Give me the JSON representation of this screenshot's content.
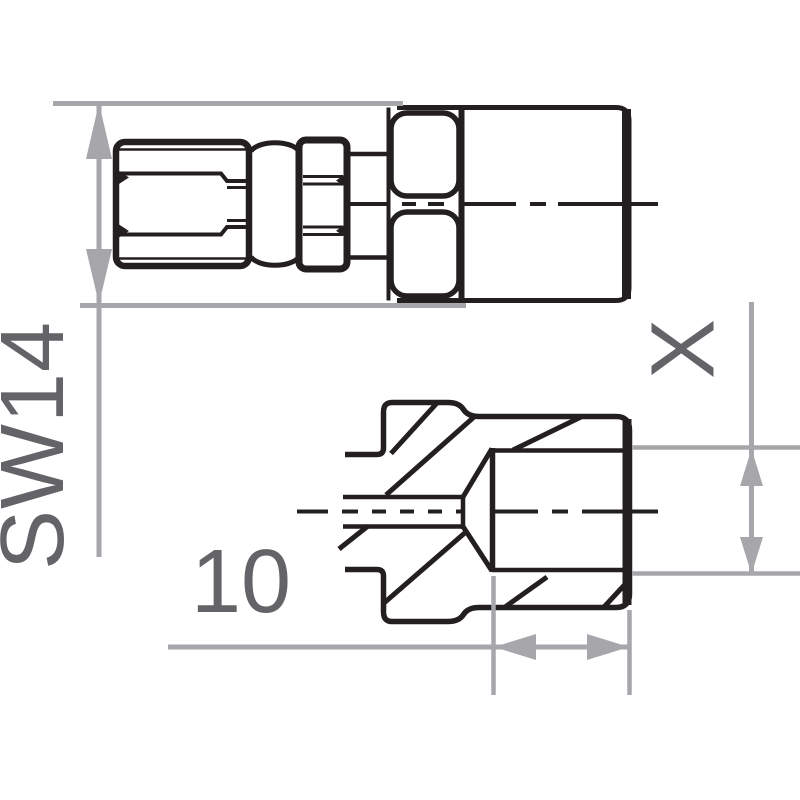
{
  "page": {
    "background": "#ffffff"
  },
  "drawing": {
    "description_labels": {
      "wrench_size": "SW14",
      "thread_length": "10",
      "thread_size": "X"
    },
    "colors": {
      "ink": "#231f20",
      "dimension": "#a7a7ab",
      "label": "#646468"
    }
  }
}
